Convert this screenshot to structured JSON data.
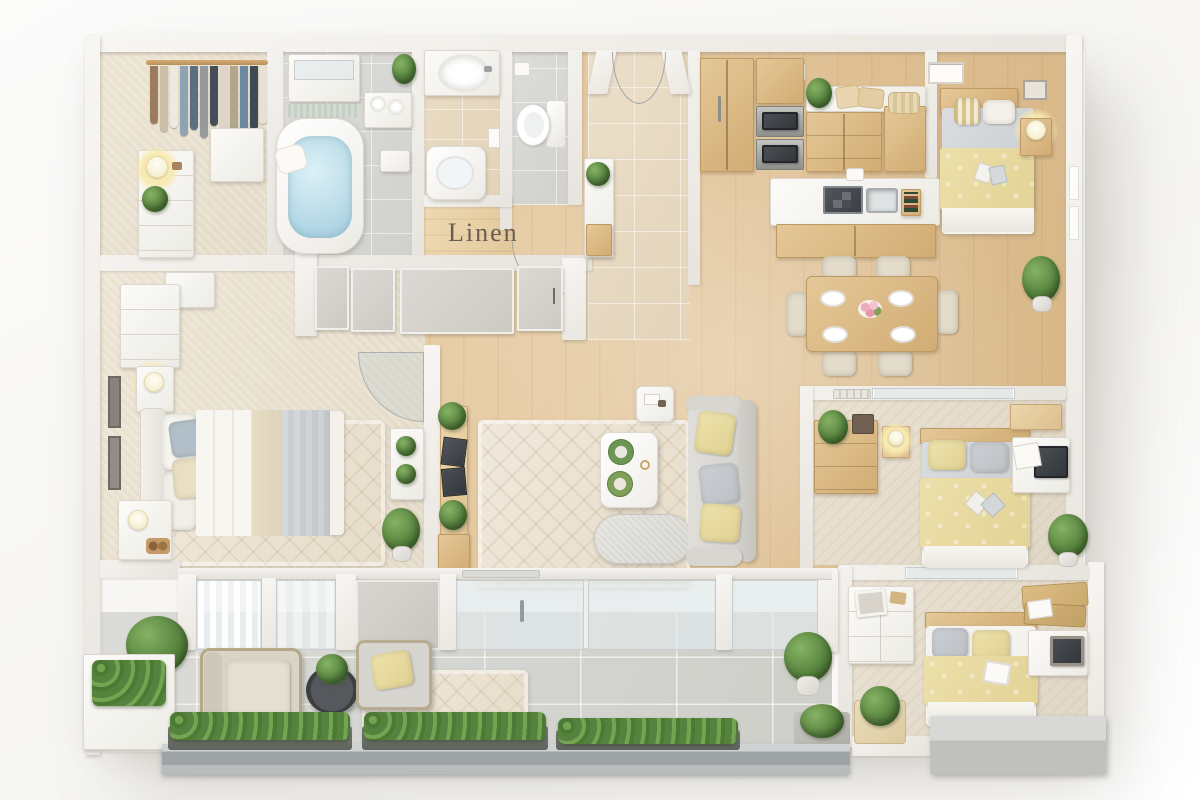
{
  "scene": {
    "type": "3d-floor-plan-render",
    "label_linen": "Linen"
  },
  "palette": {
    "background": "#fafaf9",
    "wall": "#f5f3f0",
    "wood_floor": "#e2c79e",
    "wood_furniture": "#d7b483",
    "carpet": "#e9e1d1",
    "bath_tile": "#d8d8d5",
    "patio_tile": "#d6d6d3",
    "rug": "#ece5d7",
    "duvet_yellow": "#e8dca4",
    "cool_gray": "#c7cbce",
    "sofa_gray": "#dbd9d4",
    "plant_green": "#5c8a42",
    "water_blue": "#c2e0ea",
    "metal_railing": "#aab0b2",
    "label_text": "#5e5549"
  }
}
